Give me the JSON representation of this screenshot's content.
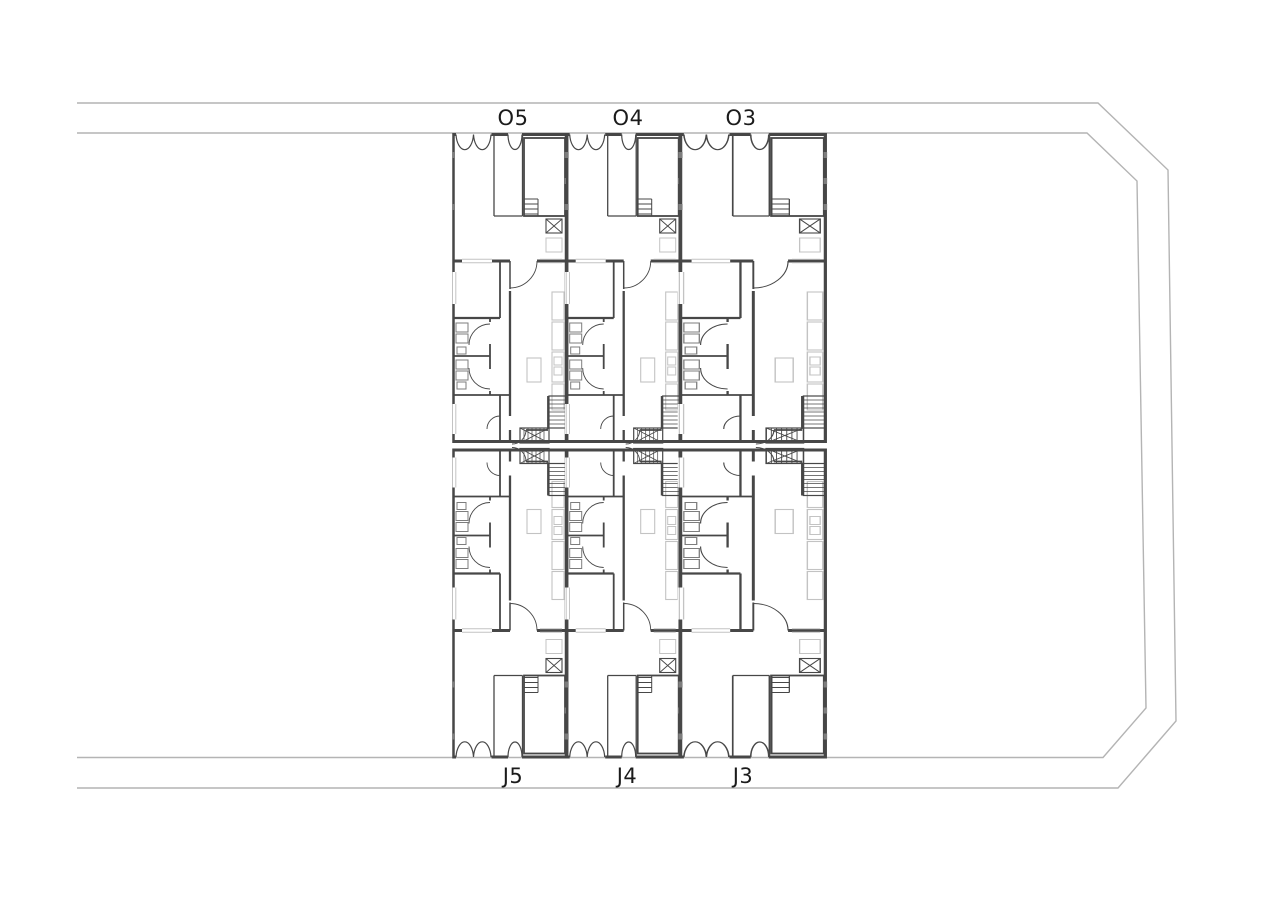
{
  "plan": {
    "drawing_type": "residential floor plan",
    "top_units": [
      "O5",
      "O4",
      "O3"
    ],
    "bottom_units": [
      "J5",
      "J4",
      "J3"
    ]
  },
  "colors": {
    "background": "#ffffff",
    "wall": "#474747",
    "site_line": "#b4b4b4",
    "light_detail": "#c3c3c3",
    "fixture": "#7d7d7d",
    "label_text": "#1b1b1b"
  }
}
